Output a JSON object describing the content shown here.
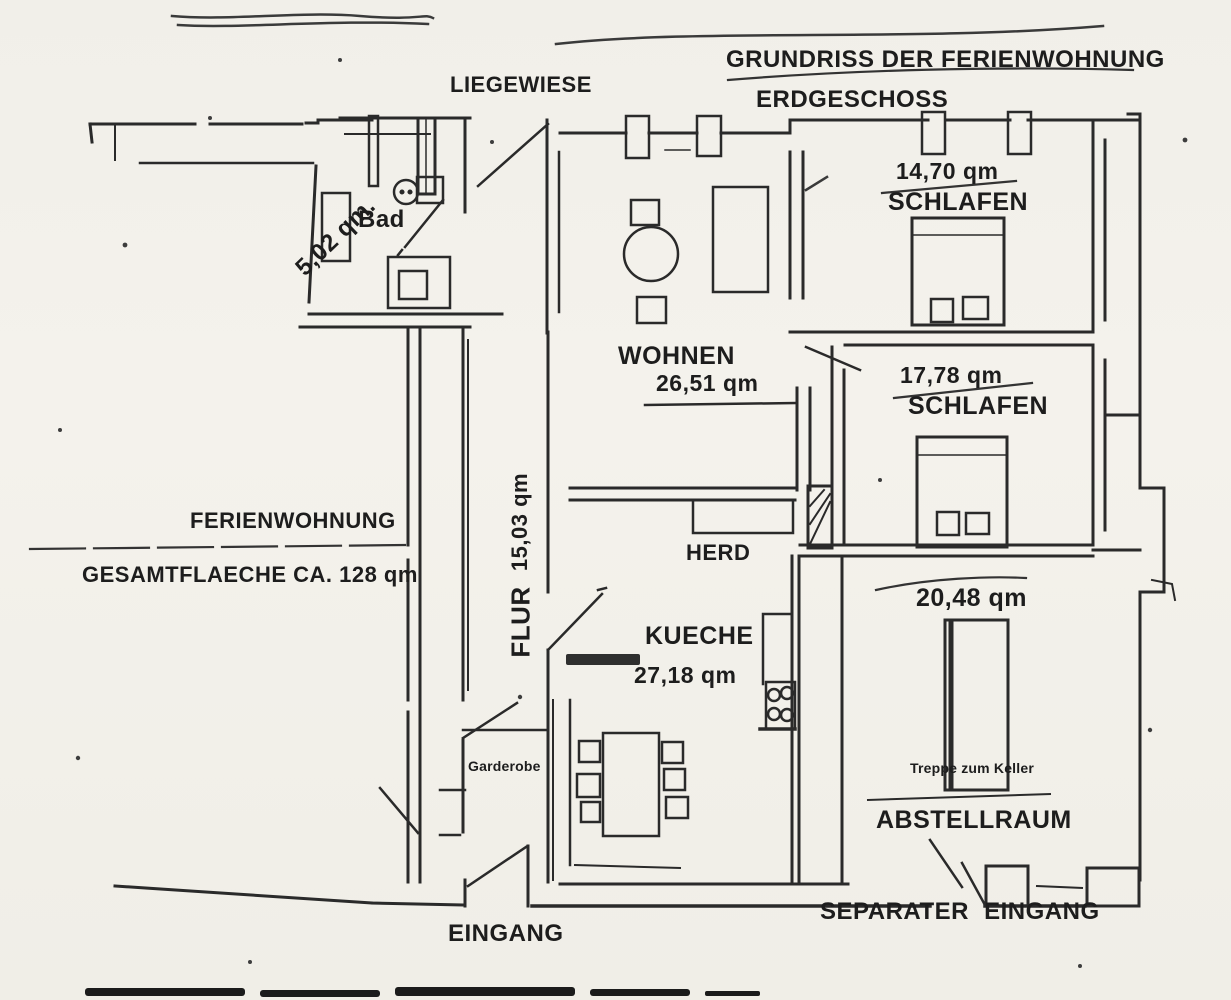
{
  "document": {
    "title": "GRUNDRISS DER FERIENWOHNUNG",
    "subtitle": "ERDGESCHOSS"
  },
  "outdoor": {
    "liegewiese": "LIEGEWIESE"
  },
  "summary": {
    "name": "FERIENWOHNUNG",
    "total_area": "GESAMTFLAECHE CA. 128 qm"
  },
  "rooms": {
    "bad": {
      "label": "Bad",
      "area": "5,02 qm."
    },
    "schlafen1": {
      "label": "SCHLAFEN",
      "area": "14,70 qm"
    },
    "wohnen": {
      "label": "WOHNEN",
      "area": "26,51 qm"
    },
    "schlafen2": {
      "label": "SCHLAFEN",
      "area": "17,78 qm"
    },
    "flur": {
      "label": "FLUR",
      "area": "15,03 qm"
    },
    "kueche": {
      "label": "KUECHE",
      "area": "27,18 qm"
    },
    "abstellraum": {
      "label": "ABSTELLRAUM",
      "area": "20,48 qm"
    }
  },
  "features": {
    "herd": "HERD",
    "garderobe": "Garderobe",
    "treppe_zum_keller": "Treppe zum Keller",
    "eingang": "EINGANG",
    "separater_eingang": "SEPARATER EINGANG"
  },
  "colors": {
    "ink": "#222222",
    "paper": "#f2f0ea"
  }
}
